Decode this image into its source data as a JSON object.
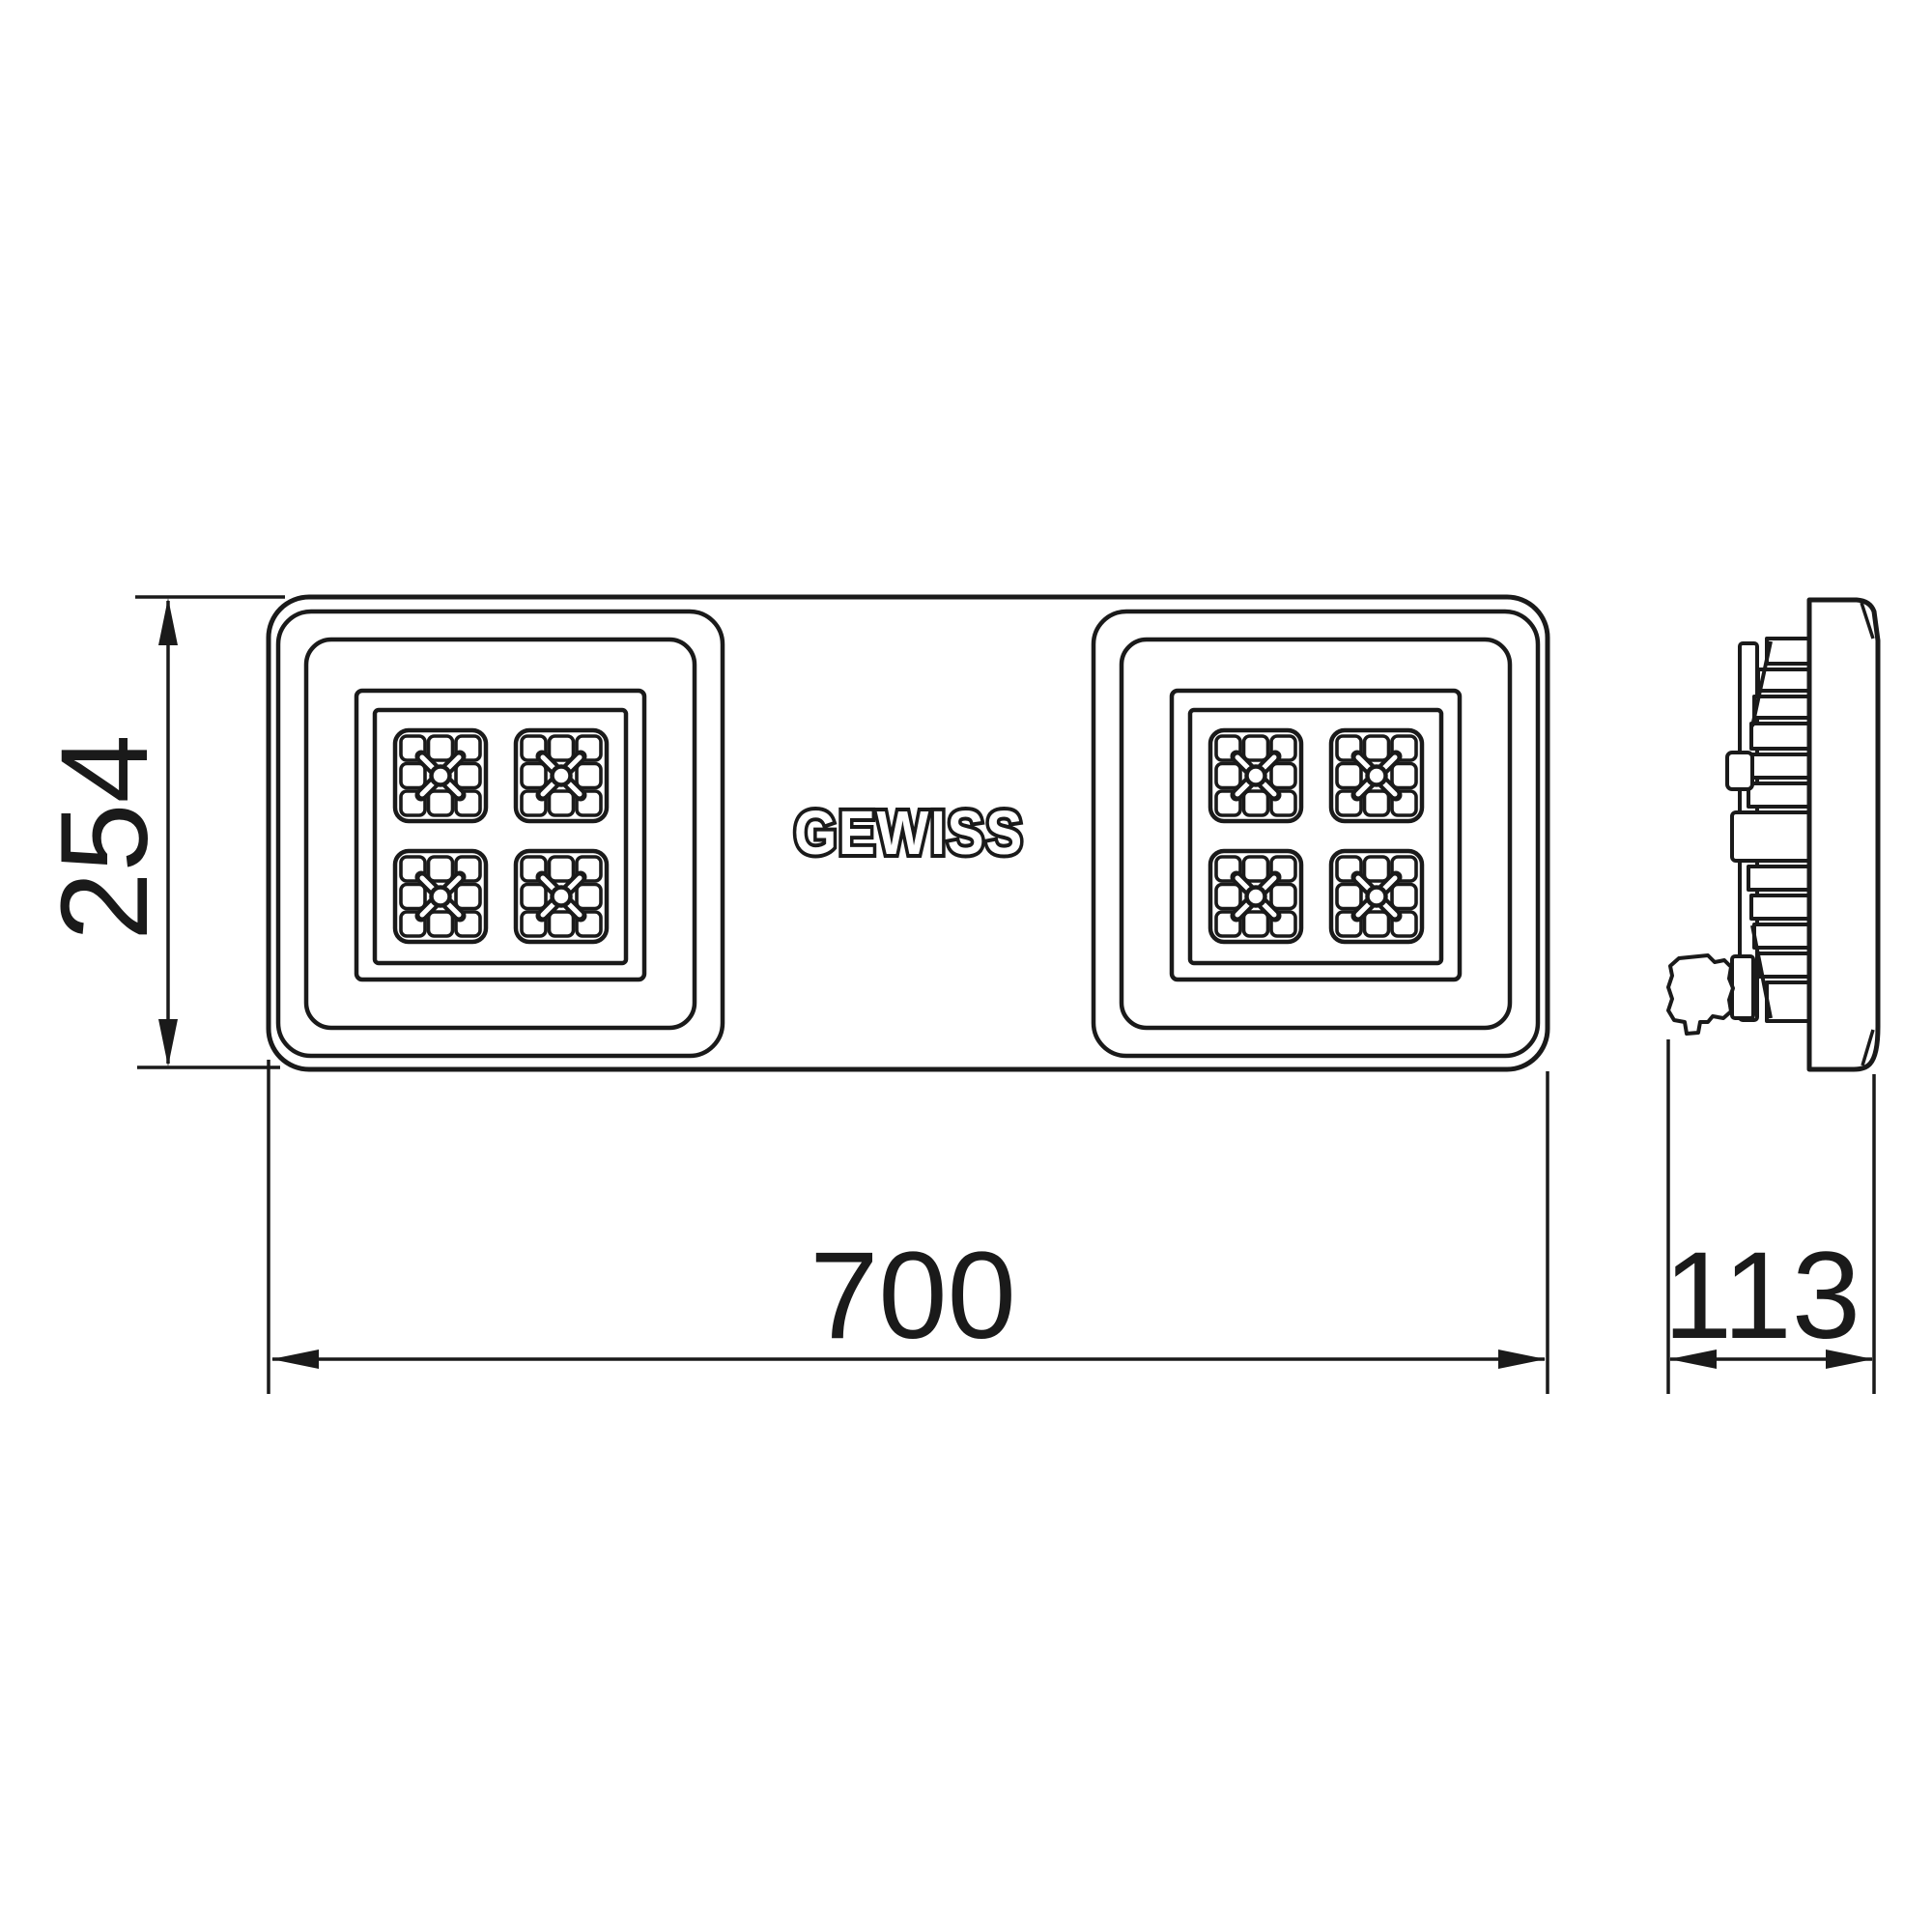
{
  "drawing": {
    "brand": "GEWISS",
    "line_color": "#1a1a1a",
    "background": "#ffffff",
    "dimensions": {
      "height_mm": "254",
      "width_mm": "700",
      "depth_mm": "113"
    }
  }
}
